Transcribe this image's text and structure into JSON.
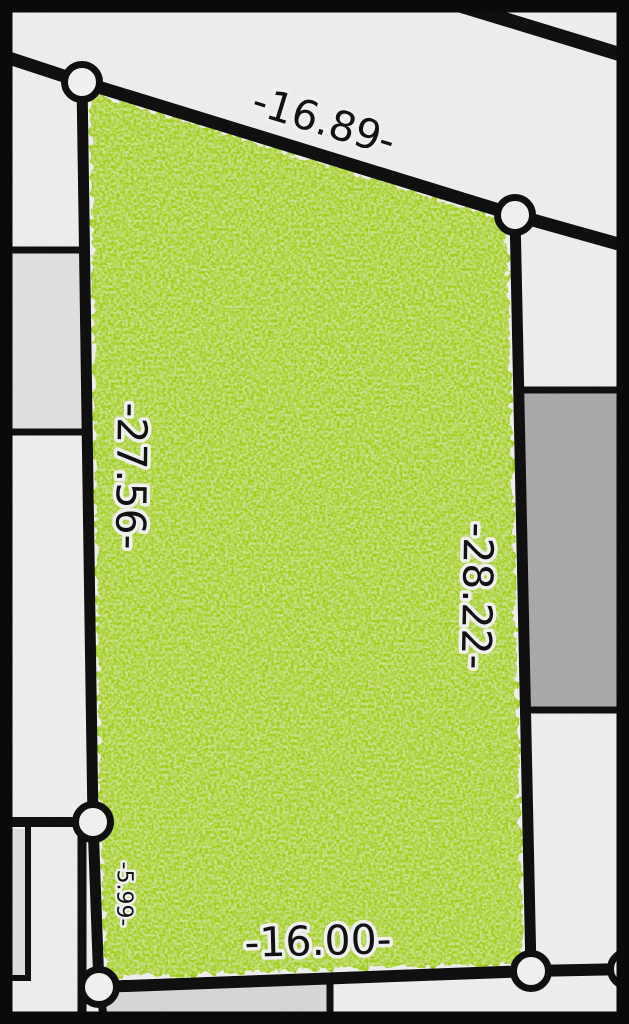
{
  "map": {
    "description": "Cadastral parcel map with one highlighted lot and dimension labels on each boundary edge",
    "colors": {
      "background": "#fcfcfc",
      "line": "#111111",
      "highlight_fill": "#abdc1e",
      "adjacent_dark_gray": "#b4b4b4",
      "adjacent_light_gray": "#ededed",
      "bottom_gray": "#e4e4e4",
      "strip_gray": "#eaeaea",
      "vertex_fill": "#ffffff",
      "label_color": "#141414",
      "label_halo": "#ffffff",
      "frame": "#0a0a0a"
    },
    "highlighted_parcel": {
      "vertex_count": 6,
      "edges": {
        "top": {
          "label": "-16.89-",
          "length": 16.89
        },
        "left": {
          "label": "-27.56-",
          "length": 27.56
        },
        "right": {
          "label": "-28.22-",
          "length": 28.22
        },
        "bottom": {
          "label": "-16.00-",
          "length": 16.0
        },
        "left_lower": {
          "label": "-5.99-",
          "length": 5.99
        }
      }
    }
  }
}
